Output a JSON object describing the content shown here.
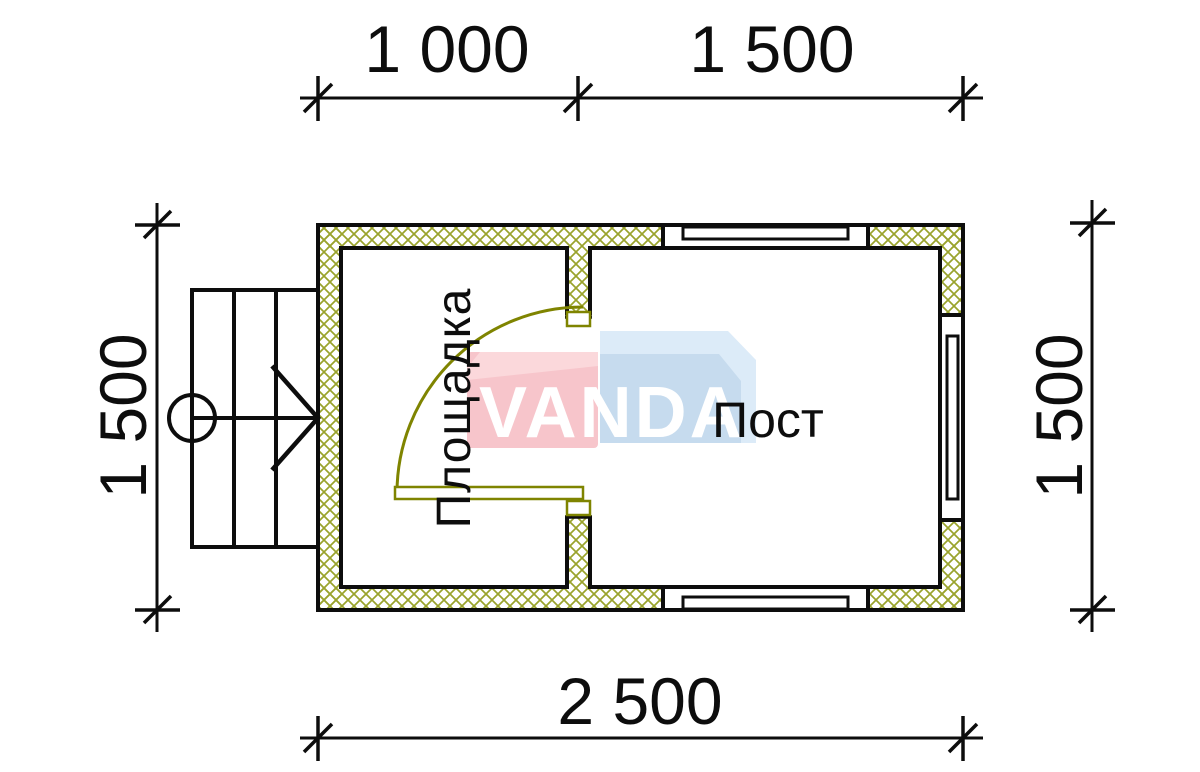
{
  "colors": {
    "ink": "#0d0d0d",
    "hatch": "#9aa32c",
    "door": "#7f8400",
    "wm-pink": "#f7c5cb",
    "wm-pink-light": "#fbd8db",
    "wm-blue": "#c6dbee",
    "wm-blue-light": "#dcebf8",
    "wm-text": "#ffffff",
    "paper": "#ffffff"
  },
  "dimensions": {
    "top_left": "1 000",
    "top_right": "1 500",
    "left": "1 500",
    "right": "1 500",
    "bottom": "2 500"
  },
  "rooms": {
    "left": "Площадка",
    "right": "Пост"
  },
  "watermark": {
    "text": "VANDA"
  }
}
